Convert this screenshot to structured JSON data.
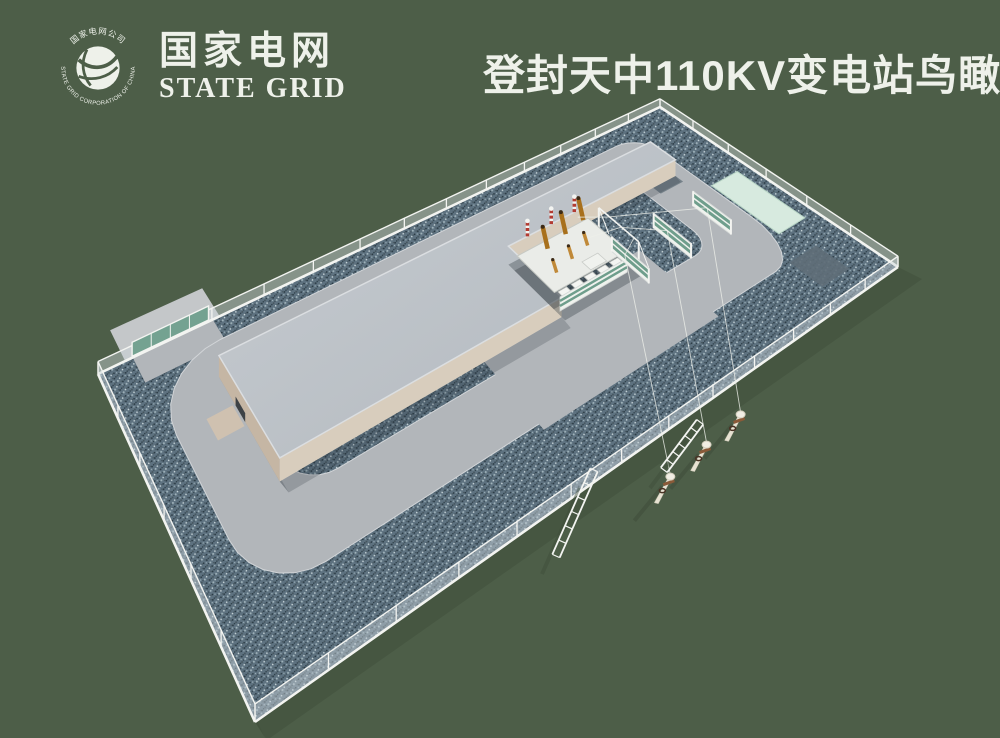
{
  "header": {
    "logo": {
      "ring_text_top": "国家电网公司",
      "ring_text_bottom": "STATE GRID CORPORATION OF CHINA",
      "name_cn": "国家电网",
      "name_en": "STATE GRID"
    },
    "title": "登封天中110KV变电站鸟瞰图"
  },
  "colors": {
    "background": "#4d5e48",
    "text": "#eef1ea",
    "gravel_base": "#5e7280",
    "gravel_dark": "#2c3c46",
    "gravel_mid": "#46565f",
    "gravel_light": "#9fb2ba",
    "gravel_pale": "#c9d6da",
    "road": "#b2b6ba",
    "apron": "#c4c7c9",
    "road_curb": "#d2d5d8",
    "roof_light": "#c7ccd1",
    "roof_dark": "#b2b8be",
    "roof_edge": "#dbdee1",
    "wall_tan": "#d8cdbd",
    "wall_tan_dark": "#c5b6a4",
    "fence_white": "#f3f4f1",
    "fence_mesh": "#ccd4d9",
    "gate_teal": "#74a291",
    "mint_pad": "#d7eadf",
    "mint_edge": "#b9d6c6",
    "pad_gray": "#6e7b84",
    "pad_gray_dark": "#5f6e78",
    "screen_green": "#6f9e8c",
    "transformer_white": "#eaece8",
    "bushing_brown": "#a8701c",
    "bushing_orange": "#c08938",
    "arrester_red": "#b23b32",
    "pole_cream": "#e7e2d2",
    "crossarm_brown": "#8a5a38",
    "wire": "#eef0ea",
    "shadow": "#3f4d3a"
  }
}
